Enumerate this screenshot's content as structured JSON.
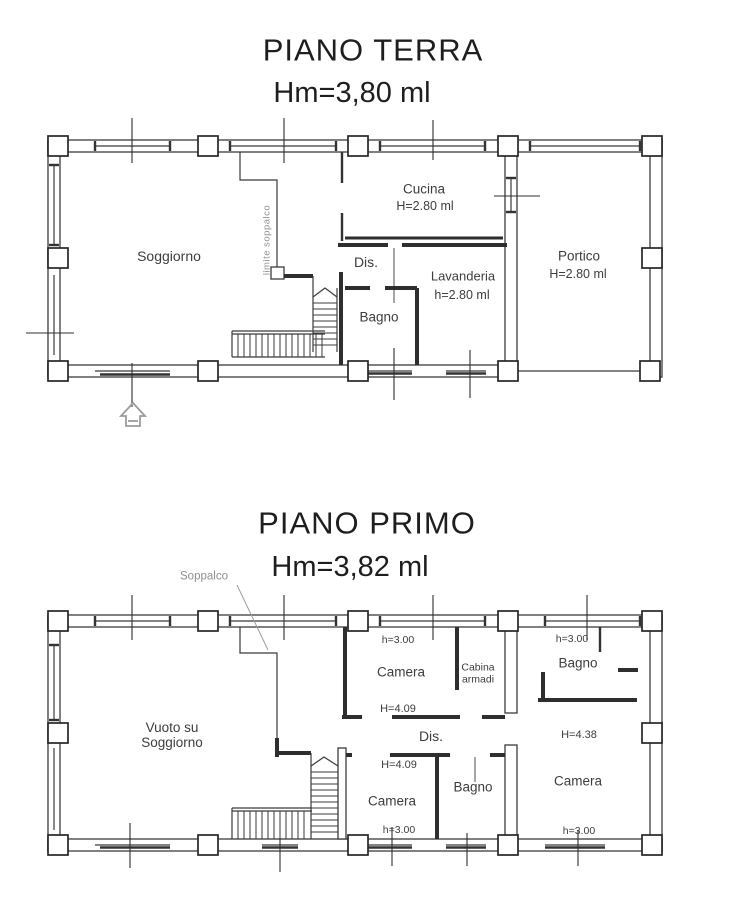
{
  "ground": {
    "title": "PIANO TERRA",
    "subtitle": "Hm=3,80 ml",
    "labels": {
      "soggiorno": "Soggiorno",
      "cucina": "Cucina",
      "cucina_h": "H=2.80 ml",
      "dis": "Dis.",
      "bagno": "Bagno",
      "lavanderia": "Lavanderia",
      "lavanderia_h": "h=2.80 ml",
      "portico": "Portico",
      "portico_h": "H=2.80 ml",
      "limite_soppalco": "limite soppalco"
    }
  },
  "first": {
    "title": "PIANO PRIMO",
    "subtitle": "Hm=3,82 ml",
    "labels": {
      "soppalco": "Soppalco",
      "vuoto_1": "Vuoto su",
      "vuoto_2": "Soggiorno",
      "camera_top": "Camera",
      "camera_top_h": "h=3.00",
      "camera_top_H": "H=4.09",
      "cabina_1": "Cabina",
      "cabina_2": "armadi",
      "dis": "Dis.",
      "camera_mid": "Camera",
      "camera_mid_H": "H=4.09",
      "camera_mid_h": "h=3.00",
      "bagno_mid": "Bagno",
      "bagno_right": "Bagno",
      "bagno_right_h": "h=3.00",
      "camera_right": "Camera",
      "camera_right_H": "H=4.38",
      "camera_right_h": "h=3.00"
    }
  },
  "colors": {
    "line": "#3b3b3b",
    "text": "#3d3d3d",
    "muted": "#8f8f8f"
  }
}
